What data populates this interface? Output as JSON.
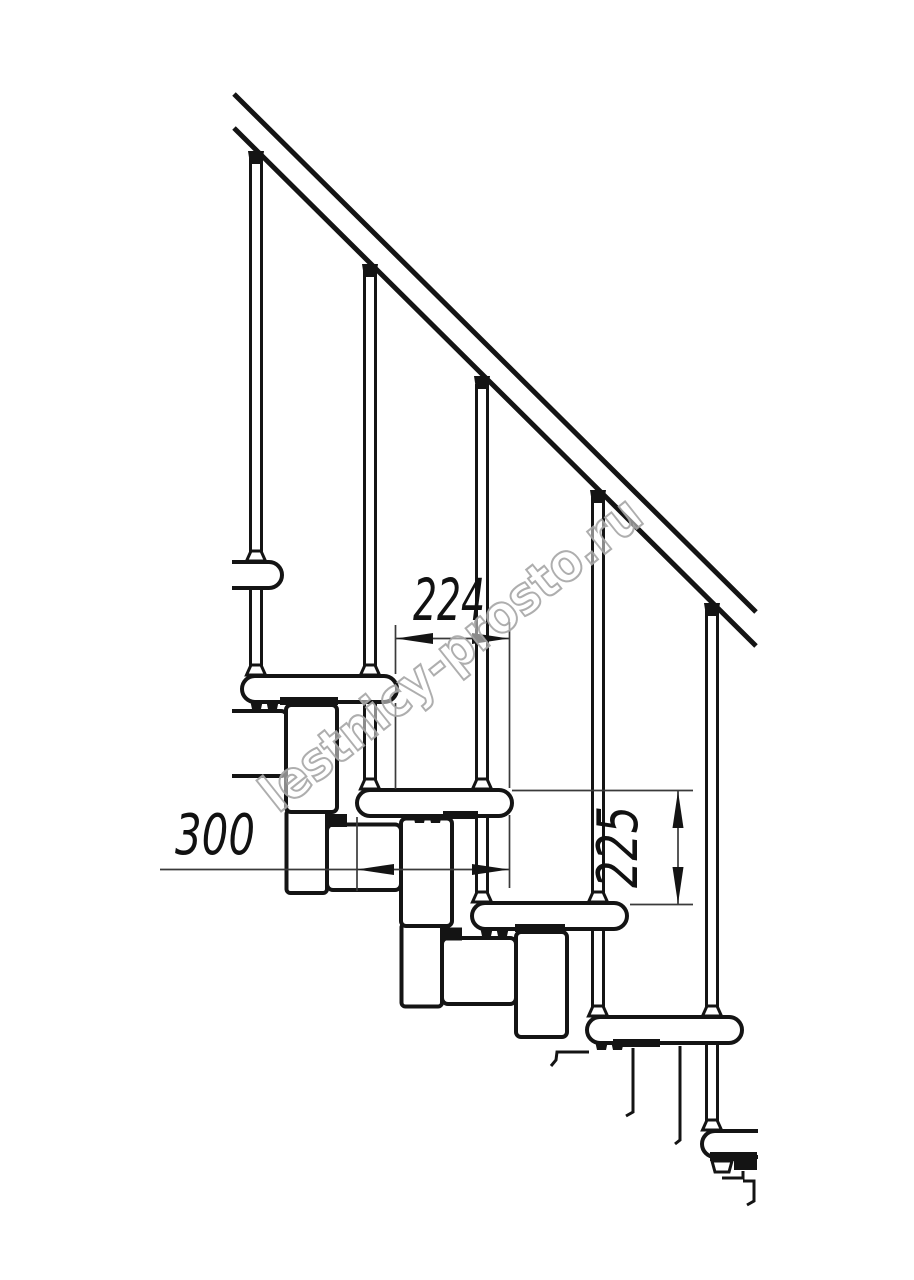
{
  "drawing": {
    "type": "modular-staircase-side-view",
    "dimensions": {
      "step_run": "224",
      "tread_depth": "300",
      "riser_height": "225"
    },
    "watermark": "lestnicy-prosto.ru",
    "colors": {
      "ink": "#141414",
      "background": "#ffffff",
      "watermark_stroke": "#a5a5a5"
    }
  }
}
